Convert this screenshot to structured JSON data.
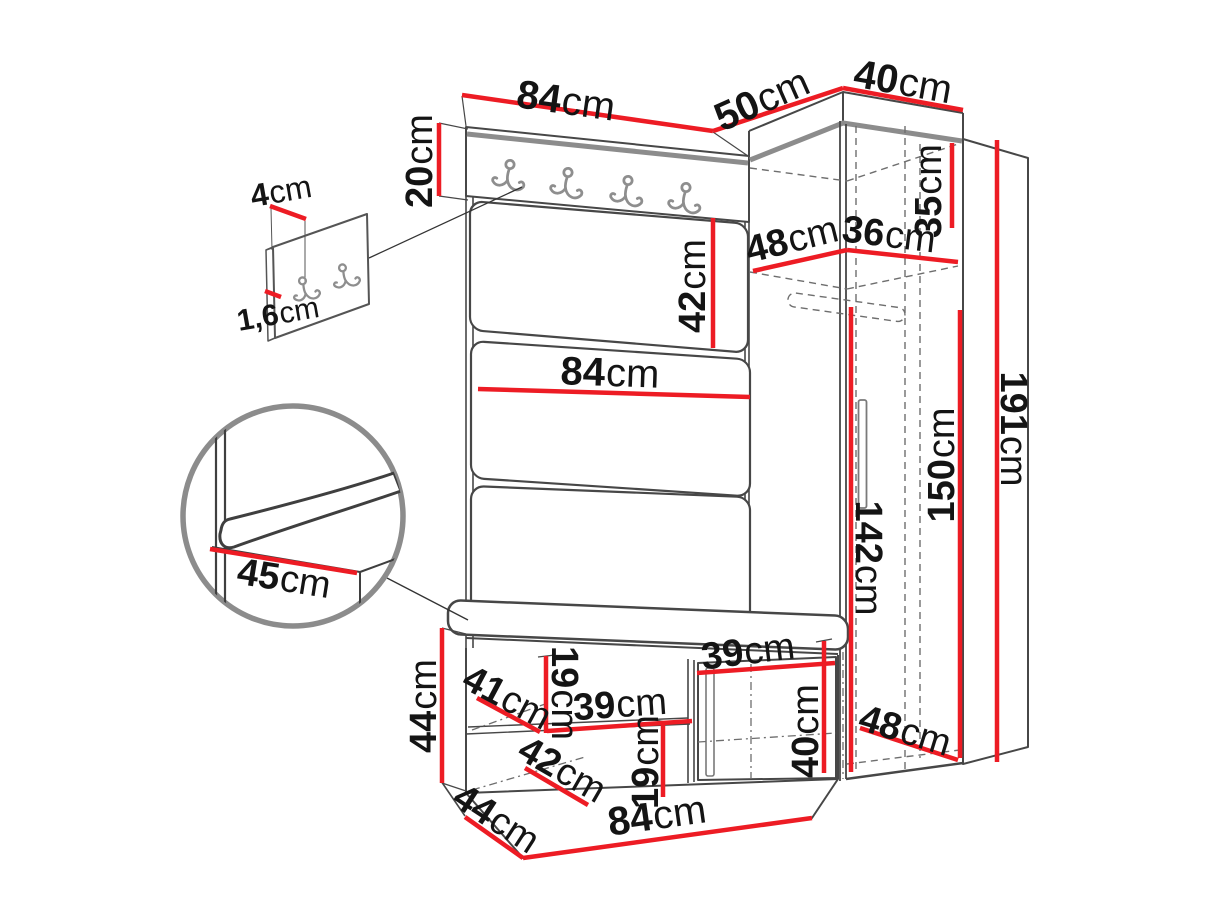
{
  "colors": {
    "dimension_red": "#ed1c24",
    "outline_dark": "#474747",
    "outline_grey": "#8c8c8c",
    "dash_grey": "#6e6e6e",
    "text": "#141414",
    "background": "#ffffff"
  },
  "dimensions": [
    {
      "name": "panel-top-width",
      "value": "84",
      "unit": "cm",
      "x": 566,
      "y": 101,
      "rotate": 8,
      "size": 40,
      "line": [
        462,
        95,
        713,
        131
      ]
    },
    {
      "name": "niche-top-width",
      "value": "50",
      "unit": "cm",
      "x": 762,
      "y": 100,
      "rotate": -24,
      "size": 40,
      "line": [
        713,
        131,
        843,
        88
      ]
    },
    {
      "name": "wardrobe-top-depth",
      "value": "40",
      "unit": "cm",
      "x": 903,
      "y": 82,
      "rotate": 10,
      "size": 40,
      "line": [
        843,
        88,
        963,
        110
      ]
    },
    {
      "name": "hook-board-height",
      "value": "20",
      "unit": "cm",
      "x": 420,
      "y": 161,
      "rotate": -90,
      "size": 38,
      "line": [
        439,
        123,
        439,
        196
      ]
    },
    {
      "name": "detail-hook-offset",
      "value": "4",
      "unit": "cm",
      "x": 281,
      "y": 191,
      "rotate": -10,
      "size": 32,
      "line": [
        270,
        206,
        306,
        219
      ]
    },
    {
      "name": "detail-panel-thickness",
      "value": "1,6",
      "unit": "cm",
      "x": 278,
      "y": 314,
      "rotate": -10,
      "size": 30,
      "line": [
        265,
        291,
        281,
        297
      ]
    },
    {
      "name": "cushion-height",
      "value": "42",
      "unit": "cm",
      "x": 693,
      "y": 286,
      "rotate": -90,
      "size": 38,
      "line": [
        713,
        218,
        713,
        348
      ]
    },
    {
      "name": "niche-shelf-depth",
      "value": "48",
      "unit": "cm",
      "x": 792,
      "y": 240,
      "rotate": -14,
      "size": 38,
      "line": [
        753,
        271,
        847,
        250
      ]
    },
    {
      "name": "wardrobe-inner-width",
      "value": "36",
      "unit": "cm",
      "x": 889,
      "y": 235,
      "rotate": 7,
      "size": 38,
      "line": [
        847,
        250,
        958,
        262
      ]
    },
    {
      "name": "top-compartment-height",
      "value": "35",
      "unit": "cm",
      "x": 929,
      "y": 191,
      "rotate": -90,
      "size": 38,
      "line": [
        952,
        143,
        952,
        228
      ]
    },
    {
      "name": "panel-mid-width",
      "value": "84",
      "unit": "cm",
      "x": 610,
      "y": 373,
      "rotate": 2,
      "size": 40,
      "line": [
        478,
        389,
        750,
        397
      ]
    },
    {
      "name": "seat-depth-detail",
      "value": "45",
      "unit": "cm",
      "x": 284,
      "y": 579,
      "rotate": 9,
      "size": 38,
      "line": [
        210,
        549,
        357,
        573
      ]
    },
    {
      "name": "wardrobe-door-height",
      "value": "150",
      "unit": "cm",
      "x": 942,
      "y": 465,
      "rotate": -90,
      "size": 38,
      "line": [
        960,
        310,
        960,
        758
      ]
    },
    {
      "name": "wardrobe-inner-height",
      "value": "142",
      "unit": "cm",
      "x": 868,
      "y": 558,
      "rotate": 90,
      "size": 38,
      "line": [
        851,
        307,
        851,
        772
      ]
    },
    {
      "name": "total-height",
      "value": "191",
      "unit": "cm",
      "x": 1013,
      "y": 429,
      "rotate": 90,
      "size": 38,
      "line": [
        997,
        140,
        997,
        762
      ]
    },
    {
      "name": "bench-height",
      "value": "44",
      "unit": "cm",
      "x": 424,
      "y": 706,
      "rotate": -90,
      "size": 38,
      "line": [
        442,
        628,
        442,
        783
      ]
    },
    {
      "name": "bench-depth-top",
      "value": "41",
      "unit": "cm",
      "x": 507,
      "y": 698,
      "rotate": 28,
      "size": 38,
      "line": [
        477,
        698,
        540,
        732
      ]
    },
    {
      "name": "shelf-gap-left",
      "value": "19",
      "unit": "cm",
      "x": 564,
      "y": 693,
      "rotate": 90,
      "size": 38,
      "line": [
        546,
        656,
        546,
        733
      ]
    },
    {
      "name": "shelf-width-left",
      "value": "39",
      "unit": "cm",
      "x": 620,
      "y": 705,
      "rotate": -4,
      "size": 38,
      "line": [
        547,
        731,
        692,
        721
      ]
    },
    {
      "name": "bench-depth-bottom",
      "value": "42",
      "unit": "cm",
      "x": 562,
      "y": 770,
      "rotate": 30,
      "size": 38,
      "line": [
        525,
        768,
        588,
        805
      ]
    },
    {
      "name": "shelf-gap-right",
      "value": "19",
      "unit": "cm",
      "x": 646,
      "y": 762,
      "rotate": -90,
      "size": 38,
      "line": [
        663,
        722,
        663,
        797
      ]
    },
    {
      "name": "bench-door-width",
      "value": "39",
      "unit": "cm",
      "x": 748,
      "y": 652,
      "rotate": -7,
      "size": 38,
      "line": [
        697,
        673,
        835,
        663
      ]
    },
    {
      "name": "bench-door-height",
      "value": "40",
      "unit": "cm",
      "x": 806,
      "y": 731,
      "rotate": -90,
      "size": 38,
      "line": [
        824,
        641,
        824,
        773
      ]
    },
    {
      "name": "bench-side-depth",
      "value": "44",
      "unit": "cm",
      "x": 496,
      "y": 819,
      "rotate": 33,
      "size": 38,
      "line": [
        465,
        817,
        523,
        858
      ]
    },
    {
      "name": "bench-width",
      "value": "84",
      "unit": "cm",
      "x": 657,
      "y": 816,
      "rotate": -8,
      "size": 40,
      "line": [
        523,
        858,
        812,
        818
      ]
    },
    {
      "name": "wardrobe-bottom-depth",
      "value": "48",
      "unit": "cm",
      "x": 905,
      "y": 731,
      "rotate": 17,
      "size": 38,
      "line": [
        860,
        728,
        958,
        760
      ]
    }
  ]
}
